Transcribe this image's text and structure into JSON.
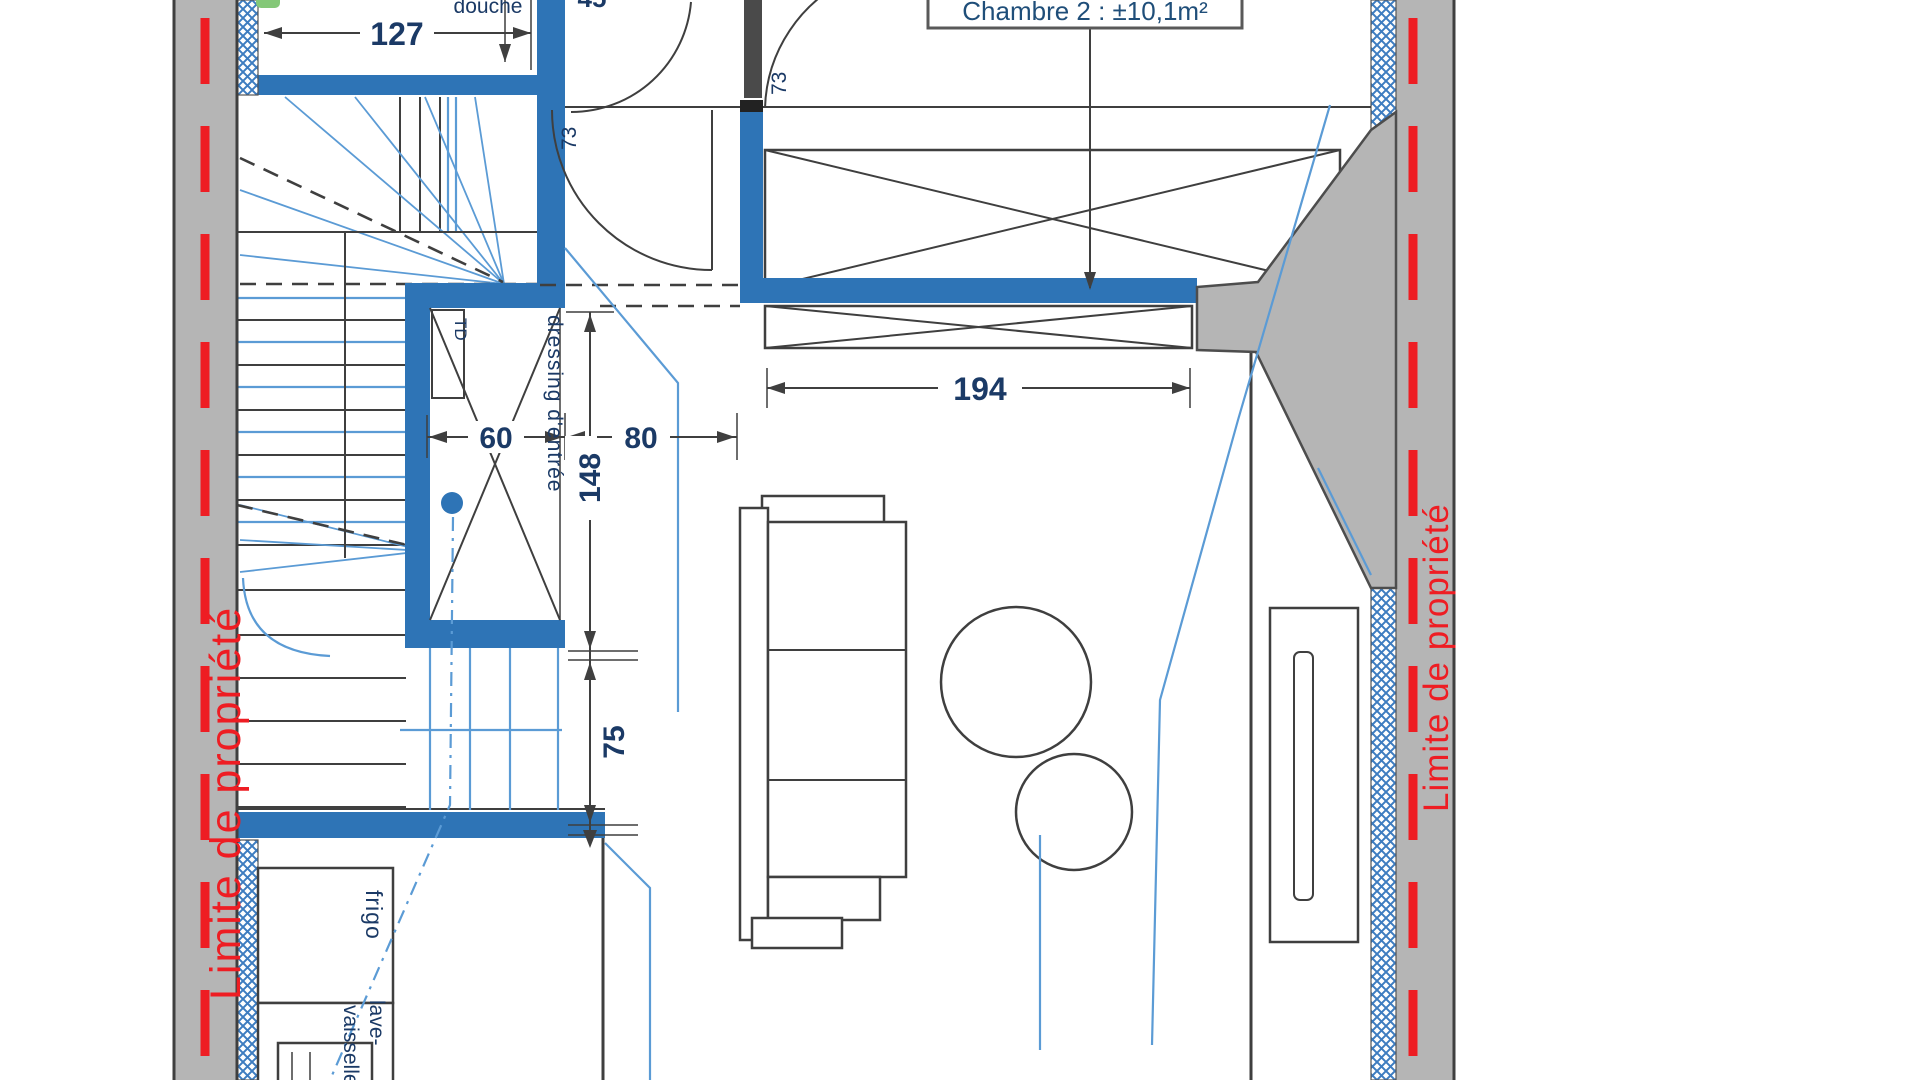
{
  "boundaries": {
    "left_label": "Limite de propriété",
    "right_label": "Limite de propriété"
  },
  "rooms": {
    "chambre2": "Chambre 2 : ±10,1m²",
    "douche": "douche",
    "dressing": "dressing d'entrée",
    "frigo": "frigo",
    "lave_line1": "lave-",
    "lave_line2": "vaisselle",
    "td": "TD"
  },
  "dimensions": {
    "d127": "127",
    "d194": "194",
    "d60": "60",
    "d80": "80",
    "d148": "148",
    "d75": "75",
    "d73_hall": "73",
    "d73_bedroom": "73",
    "d45_top": "45"
  },
  "colors": {
    "wall-blue": "#2e74b6",
    "hatch-blue": "#3d7cc0",
    "boundary-gray": "#b5b5b5",
    "boundary-red": "#ee1d23",
    "line-dark": "#3f3f3f",
    "wall-edge": "#4d4d4d",
    "text-navy": "#1b3a66",
    "cable-blue": "#5b9bd5",
    "jamb-gray": "#4a4a4a",
    "accent-green": "#84c878"
  }
}
